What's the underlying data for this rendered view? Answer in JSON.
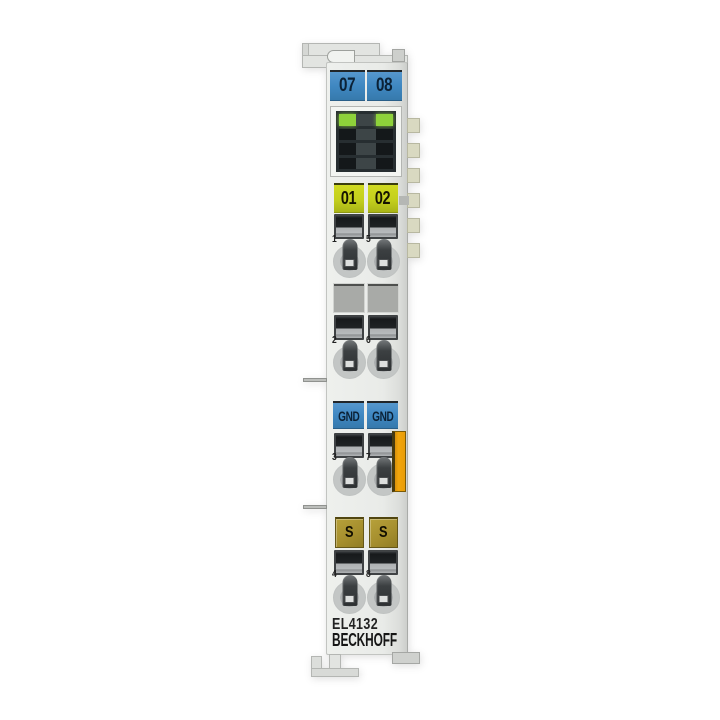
{
  "product": {
    "model": "EL4132",
    "brand": "BECKHOFF"
  },
  "labels": {
    "top": [
      "07",
      "08"
    ],
    "channel": [
      "01",
      "02"
    ],
    "gnd": [
      "GND",
      "GND"
    ],
    "shield": [
      "S",
      "S"
    ]
  },
  "contact_numbers": [
    [
      "1",
      "5"
    ],
    [
      "2",
      "6"
    ],
    [
      "3",
      "7"
    ],
    [
      "4",
      "8"
    ]
  ],
  "leds": {
    "rows": [
      [
        "on",
        "sep",
        "on"
      ],
      [
        "off",
        "sep",
        "off"
      ],
      [
        "off",
        "sep",
        "off"
      ],
      [
        "off",
        "sep",
        "off"
      ]
    ]
  },
  "colors": {
    "hook_gray": "#e2e4e1",
    "label_blue": "#3f87c1",
    "label_navy_text": "#0b2136",
    "label_yellow": "#c3cf1d",
    "label_olive": "#a68f2e",
    "orange_tab": "#f2a60c",
    "led_green": "#8ed23a",
    "led_off": "#14181a",
    "blank_gray": "#a8aaa7",
    "tab_beige": "#d9d9c1"
  }
}
